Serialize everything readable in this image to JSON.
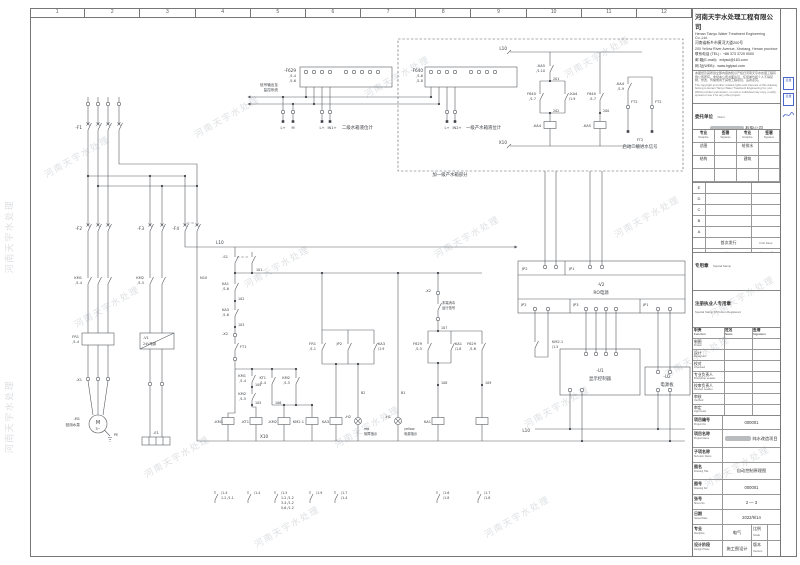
{
  "watermark": {
    "text": "河南天宇水处理"
  },
  "ruler": [
    "1",
    "2",
    "3",
    "4",
    "5",
    "6",
    "7",
    "8",
    "9",
    "10",
    "11",
    "12"
  ],
  "company": {
    "name_cn": "河南天宇水处理工程有限公司",
    "name_en": "Henan Tianyu Water Treatment Engineering Co.,Ltd.",
    "addr_cn": "河南省新乡市黄河大道200号",
    "addr_en": "200 Yellow River Avenue, Xinxiang, Henan province",
    "tel": "联系电话 (TEL)：+86 373 3720 0000",
    "email": "邮 箱(E-mail)：xxtyscl@163.com",
    "web": "网 址(WEB)：www.hgtyscl.com",
    "disclaimer_cn": "本图纸及其所载全部内容的知识产权归河南天宇水处理工程有限公司所有，未经本公司书面许可，任何单位和个人不得复制、修改、传播或用于其他工程项目，违者必究。",
    "disclaimer_en": "The copyright and other related rights and interests of this drawing belong to Henan Tianyu Water Treatment Engineering Co.,Ltd. Without written permission, no unit or individual may copy, modify, spread or use it for any other project."
  },
  "stamps": {
    "s1": "签章",
    "s2": "签章"
  },
  "titleblock": {
    "client_label": "委托单位",
    "client_en": "Client",
    "client_suffix": "有限公司",
    "disc_header": {
      "c1": "专业",
      "c1en": "Discipline",
      "c2": "签署",
      "c2en": "Signature",
      "c3": "专业",
      "c3en": "Discipline",
      "c4": "签署",
      "c4en": "Signature"
    },
    "disc_rows": {
      "r1c1": "总图",
      "r1c3": "给排水",
      "r2c1": "结构",
      "r2c3": "建筑"
    },
    "rev_letters": [
      "E",
      "D",
      "C",
      "B",
      "A"
    ],
    "first_issue": "首次发行",
    "first_issue_en": "First Issue",
    "rev_header": {
      "c1": "版次",
      "c1en": "Rev.",
      "c2": "描述",
      "c2en": "Description",
      "c3": "发行日期",
      "c3en": "Issued Date"
    },
    "stamp_label": "专用章",
    "stamp_en": "Special Stamp",
    "reg_label": "注册执业人专用章",
    "reg_en": "Special Stamp Of Person Registered",
    "person_header": {
      "c1": "职责",
      "c1en": "Function",
      "c2": "姓名",
      "c2en": "Name",
      "c3": "签署",
      "c3en": "Signature"
    },
    "person_rows": [
      {
        "cn": "制图",
        "en": "Drawn"
      },
      {
        "cn": "设计",
        "en": "Designed"
      },
      {
        "cn": "校对",
        "en": "Checked"
      },
      {
        "cn": "专业负责人",
        "en": "Discipline Leader"
      },
      {
        "cn": "校审负责人",
        "en": "Review Leader"
      },
      {
        "cn": "审核",
        "en": "Verified"
      },
      {
        "cn": "审定",
        "en": "Approved"
      },
      {
        "cn": "项目负责人",
        "en": "Project Leader"
      }
    ],
    "fields": [
      {
        "cn": "项目编号",
        "en": "Project No.",
        "val": "000001"
      },
      {
        "cn": "项目名称",
        "en": "Project Name",
        "val": "纯水改造项目"
      },
      {
        "cn": "子项名称",
        "en": "Sub-item Name",
        "val": ""
      },
      {
        "cn": "图名",
        "en": "Drawing Title",
        "val": "自动控制原理图"
      },
      {
        "cn": "图号",
        "en": "Drawing No.",
        "val": "000001"
      },
      {
        "cn": "张号",
        "en": "Sheet No.",
        "val": "2 — 3"
      },
      {
        "cn": "日期",
        "en": "Issued Date",
        "val": "2022/9/14"
      }
    ],
    "disc_row": {
      "cn": "专业",
      "en": "Discipline",
      "val": "电气",
      "cn2": "比例",
      "en2": "Scale",
      "val2": ""
    },
    "phase_row": {
      "cn": "设计阶段",
      "en": "Design Phase",
      "val": "施工图设计",
      "cn2": "版本",
      "en2": "Version",
      "val2": ""
    }
  },
  "sch": {
    "f629": "-F629",
    "f629r1": "/1.4",
    "f629r2": "/1.6",
    "f640": "-F640",
    "f640r1": "/1.6",
    "f640r2": "/1.8",
    "note_mon1": "信号输出至",
    "note_mon2": "监控系统",
    "lplus": "L+",
    "mm": "M",
    "in1": "IN1+",
    "in2": "IN2+",
    "sens1": "二级水箱液位计",
    "sens2": "一级产水箱液位计",
    "dashed_label": "加一级产水箱部分",
    "l10": "L10",
    "x10": "X10",
    "n10": "N10",
    "ka5": "-KA5",
    "ka5r": "/1.10",
    "ka4": "-KA4",
    "r19": "/1.9",
    "r17": "/1.7",
    "f640c": "F640",
    "n200": "200",
    "n201": "201",
    "n202": "202",
    "ft2": "FT2",
    "ft2note": "启动二级进水信号",
    "f1": "-F1",
    "f2": "-F2",
    "f3": "-F3",
    "f4": "-F4",
    "km1": "KM1",
    "km2": "KM2",
    "r14": "/1.4",
    "r15": "/1.5",
    "fr1": "FR1",
    "r11": "/1.1",
    "x1": "-X1",
    "m1": "-M1",
    "m1note": "回用水泵",
    "msym": "M",
    "m3": "3~",
    "pe": "PE",
    "v1": "-V1",
    "v1note": "24V电源",
    "e1": "-E1",
    "s1": "-S1",
    "n101": "101",
    "n102": "102",
    "n103": "103",
    "n104": "104",
    "n105": "105",
    "n106": "106",
    "n107": "107",
    "n108": "108",
    "n109": "109",
    "ka1": "KA1",
    "ka3": "KA3",
    "r16": "/1.6",
    "r18": "/1.8",
    "x2": "-X2",
    "ft1": "FT1",
    "kt1": "KT1",
    "km21": "KM2.1",
    "h2": "-H2",
    "h2c": "red",
    "h2note": "故障指示",
    "h1": "-H1",
    "h1c": "yellow",
    "h1note": "电源指示",
    "b1": "B1",
    "b2": "B2",
    "f629c": "F629",
    "r15b": "/1.5",
    "x2note1": "末端消毒",
    "x2note2": "运行信号",
    "jp1": "JP1",
    "jp2": "JP2",
    "jp3": "JP3",
    "v2": "-V2",
    "v2note": "RO电源",
    "u1": "-U1",
    "u1note": "显示控制器",
    "u2": "-U2",
    "u2note": "电源板",
    "coil_km1": "-KM1",
    "coil_kt1": "-KT1",
    "coil_km2": "-KM2",
    "legend": {
      "g1": [
        "/1.4",
        "1-2 /1.1"
      ],
      "g2": [
        "/1.4"
      ],
      "g3": [
        "/1.5",
        "1-2 /1.2",
        "3-4 /1.2",
        "5-6 /1.2"
      ],
      "g4": [
        "/1.9"
      ],
      "g5": [
        "/1.7",
        "/1.4"
      ],
      "g6": [
        "/1.6",
        "/1.8"
      ],
      "g7": [
        "/1.7",
        "/1.8"
      ]
    }
  }
}
